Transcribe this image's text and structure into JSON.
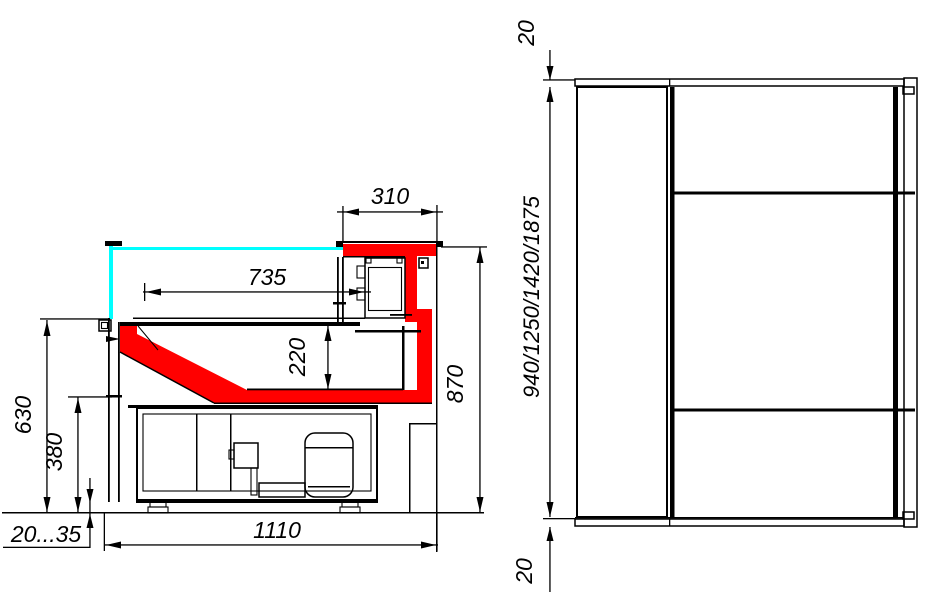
{
  "colors": {
    "highlight": "#ff0000",
    "glass": "#00ffff",
    "line": "#000000",
    "background": "#ffffff"
  },
  "side_view": {
    "d310": "310",
    "d735": "735",
    "d220": "220",
    "d630": "630",
    "d380": "380",
    "d870": "870",
    "d_foot_range": "20...35",
    "d1110": "1110"
  },
  "plan_view": {
    "d20_top": "20",
    "d_lengths": "940/1250/1420/1875",
    "d20_bottom": "20"
  }
}
